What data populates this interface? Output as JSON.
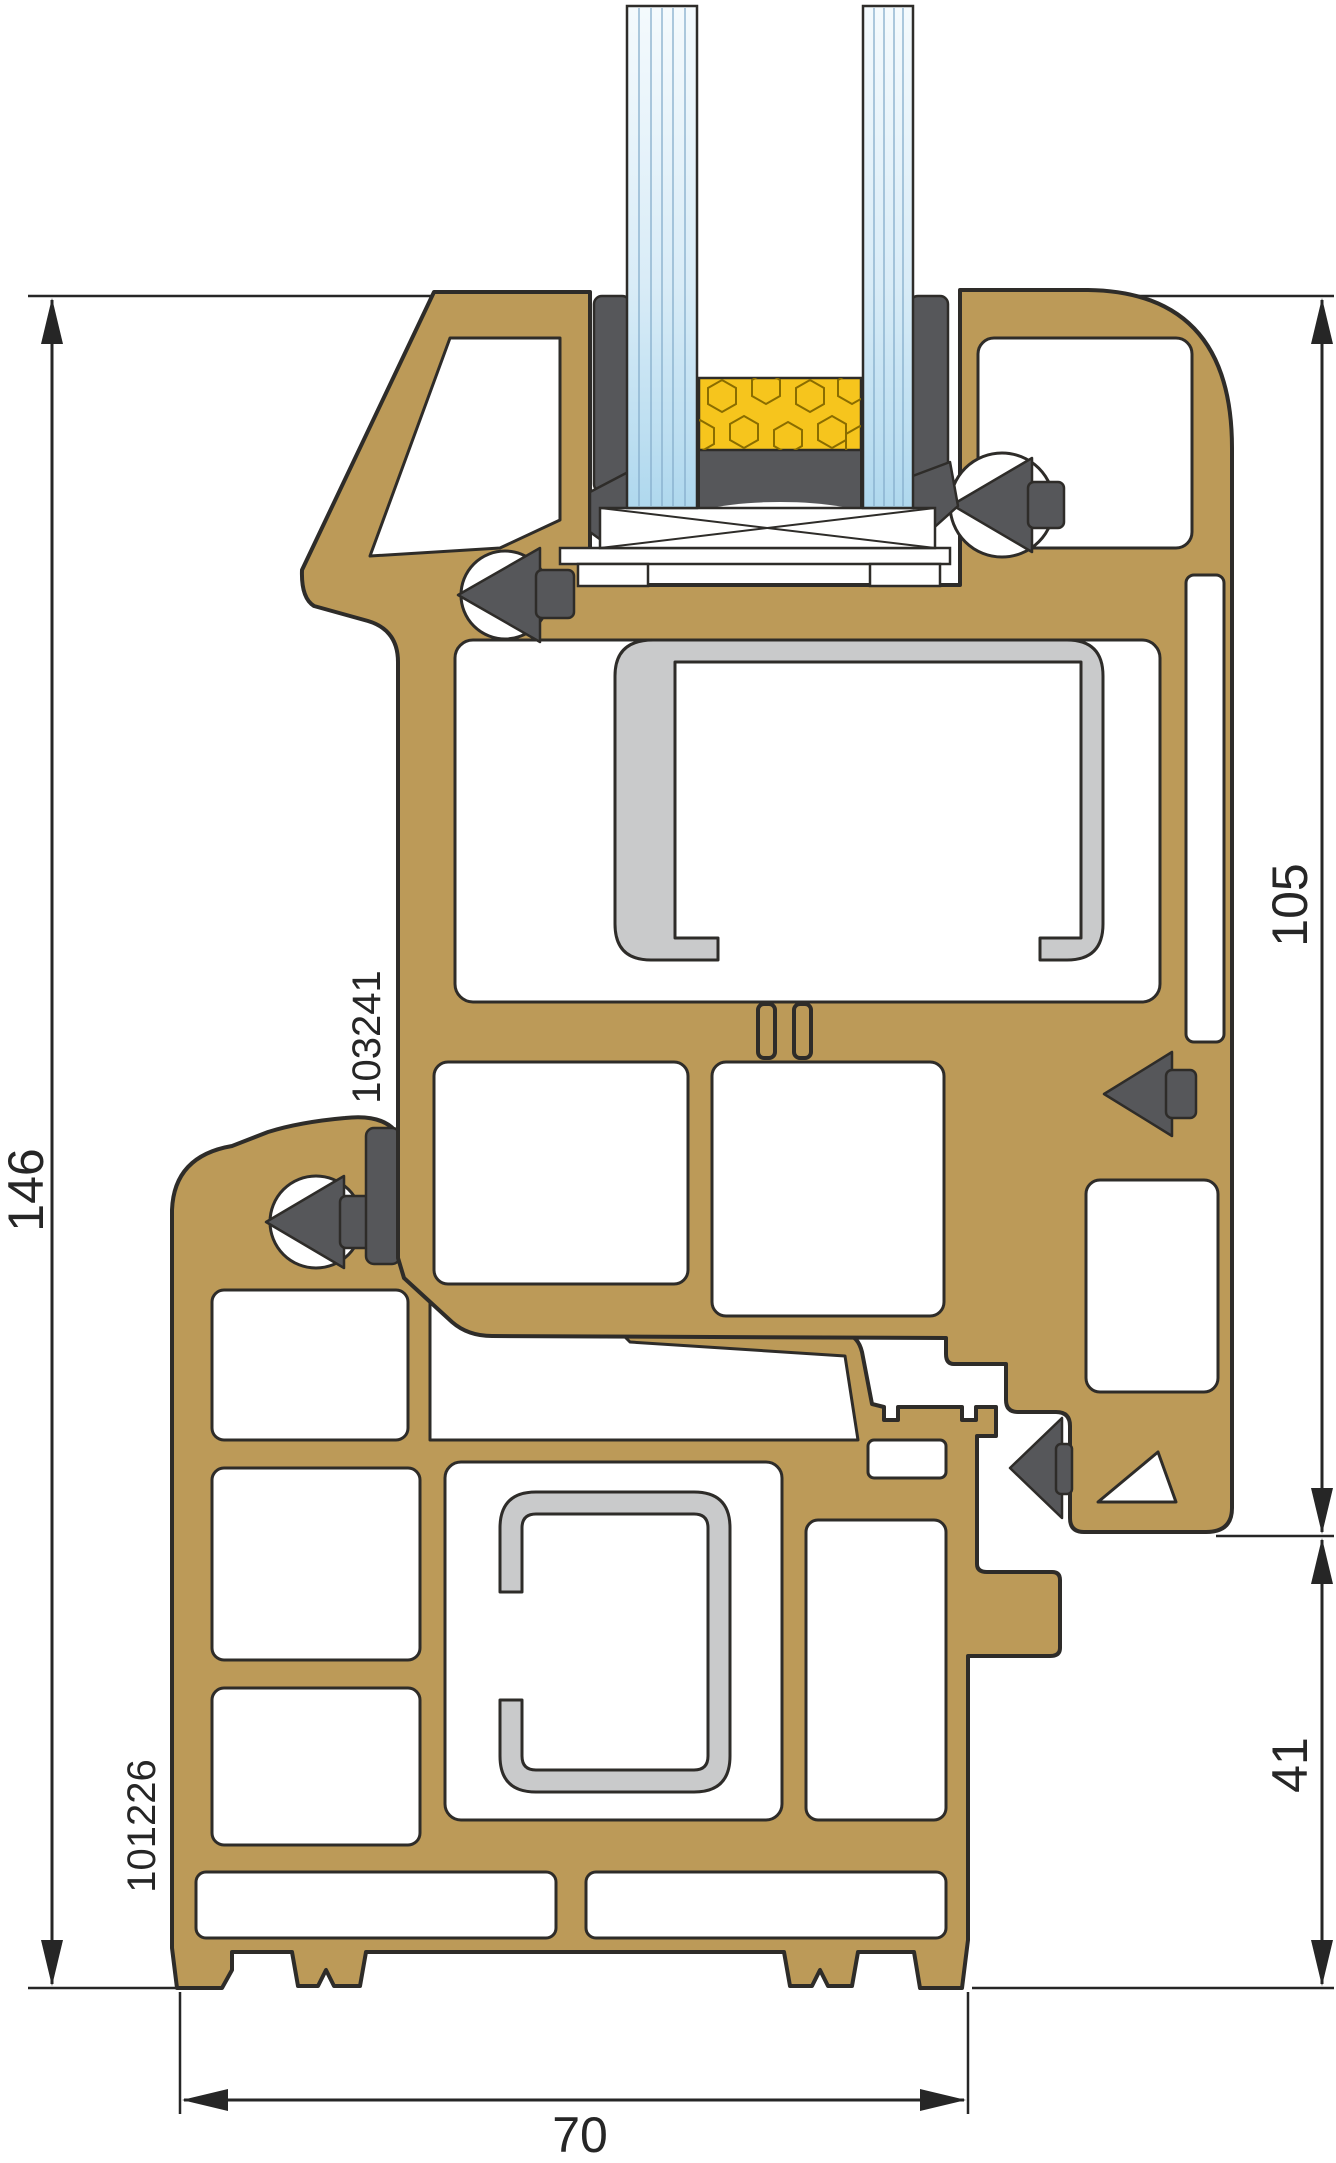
{
  "drawing": {
    "type": "window-profile-cross-section",
    "article_numbers": {
      "sash": "103241",
      "frame": "101226"
    },
    "dimensions": {
      "overall_height": "146",
      "sash_height": "105",
      "frame_height_below_sash": "41",
      "frame_depth": "70"
    },
    "colors": {
      "pvc": "#BC9A58",
      "outline": "#2E2C29",
      "steel": "#C9CACB",
      "gasket": "#56575A",
      "sealant": "#56575A",
      "glass_top": "#F4FAFD",
      "glass_mid": "#D9ECF7",
      "glass_bottom": "#AFD8EE",
      "glass_line": "#86AECC",
      "spacer": "#F6C51D",
      "spacer_line": "#8A6D00",
      "dim": "#262626",
      "white": "#FFFFFF"
    }
  }
}
